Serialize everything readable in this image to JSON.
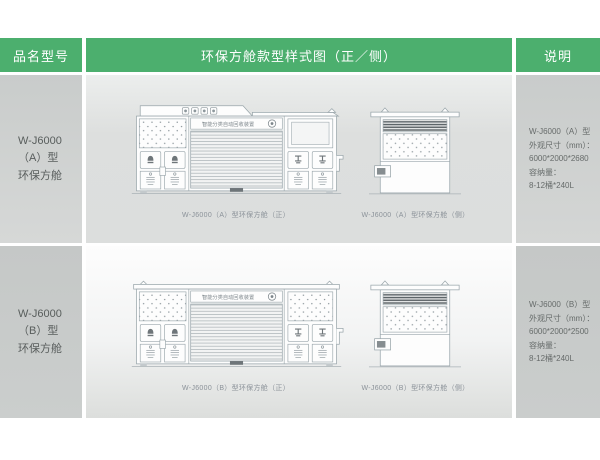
{
  "colors": {
    "header_green": "#4caf6e",
    "header_text": "#ffffff",
    "side_cell_gray": "#ced1d0",
    "diagram_cell_gray": "#dcdedd",
    "drawing_line": "#9aa6ab",
    "louver_dark": "#5a6165",
    "model_text": "#585d5c",
    "caption_text": "#8b9299"
  },
  "header": {
    "col_model": "品名型号",
    "col_diagram": "环保方舱款型样式图（正／侧）",
    "col_note": "说明"
  },
  "rows": [
    {
      "model_line1": "W-J6000（A）型",
      "model_line2": "环保方舱",
      "banner_text": "智能分类自动回收装置",
      "front_caption": "W-J6000（A）型环保方舱（正）",
      "side_caption": "W-J6000（A）型环保方舱（侧）",
      "spec_line1": "W-J6000（A）型",
      "spec_line2": "外观尺寸（mm）：",
      "spec_line3": "6000*2000*2680",
      "spec_line4": "容纳量：",
      "spec_line5": "8-12桶*240L"
    },
    {
      "model_line1": "W-J6000（B）型",
      "model_line2": "环保方舱",
      "banner_text": "智能分类自动回收装置",
      "front_caption": "W-J6000（B）型环保方舱（正）",
      "side_caption": "W-J6000（B）型环保方舱（侧）",
      "spec_line1": "W-J6000（B）型",
      "spec_line2": "外观尺寸（mm）：",
      "spec_line3": "6000*2000*2500",
      "spec_line4": "容纳量：",
      "spec_line5": "8-12桶*240L"
    }
  ],
  "icons": {
    "roof_category_icons": "four small recycling-category badges",
    "banner_logo_icon": "circular recycle logo",
    "bell_icon": "push-flap deposit door",
    "beam_icon": "beam-shaped deposit handle",
    "hook_icon": "lifting hook triangle",
    "side_bracket": "side wall bracket",
    "dots_panel": "checker-plate dotted panel",
    "roller_shutter": "roller shutter door",
    "louver_vent": "dark louver vent"
  }
}
